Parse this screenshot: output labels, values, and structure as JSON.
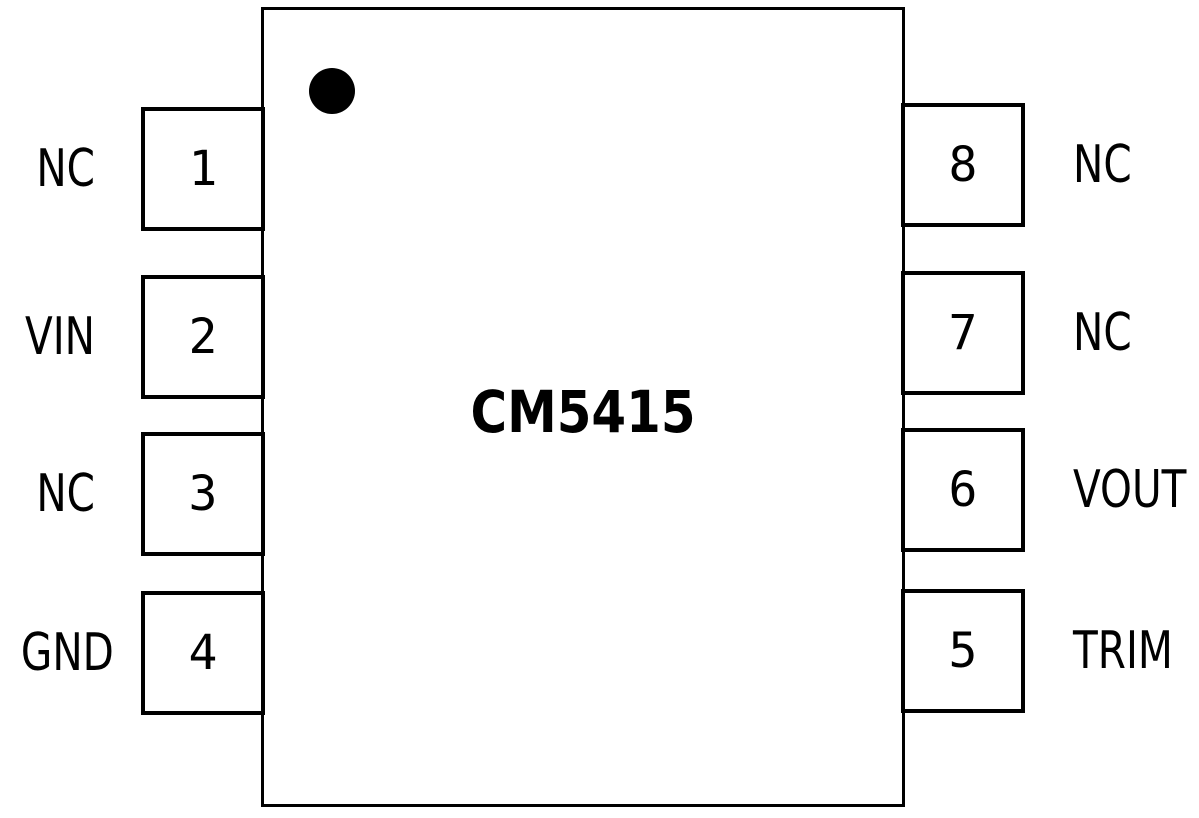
{
  "diagram": {
    "title": "CM5415",
    "type": "ic-pinout",
    "package": "8-pin dual-in-line top view"
  },
  "pins": {
    "left": [
      {
        "number": "1",
        "label": "NC"
      },
      {
        "number": "2",
        "label": "VIN"
      },
      {
        "number": "3",
        "label": "NC"
      },
      {
        "number": "4",
        "label": "GND"
      }
    ],
    "right": [
      {
        "number": "8",
        "label": "NC"
      },
      {
        "number": "7",
        "label": "NC"
      },
      {
        "number": "6",
        "label": "VOUT"
      },
      {
        "number": "5",
        "label": "TRIM"
      }
    ]
  },
  "colors": {
    "stroke": "#000000",
    "background": "#ffffff"
  }
}
